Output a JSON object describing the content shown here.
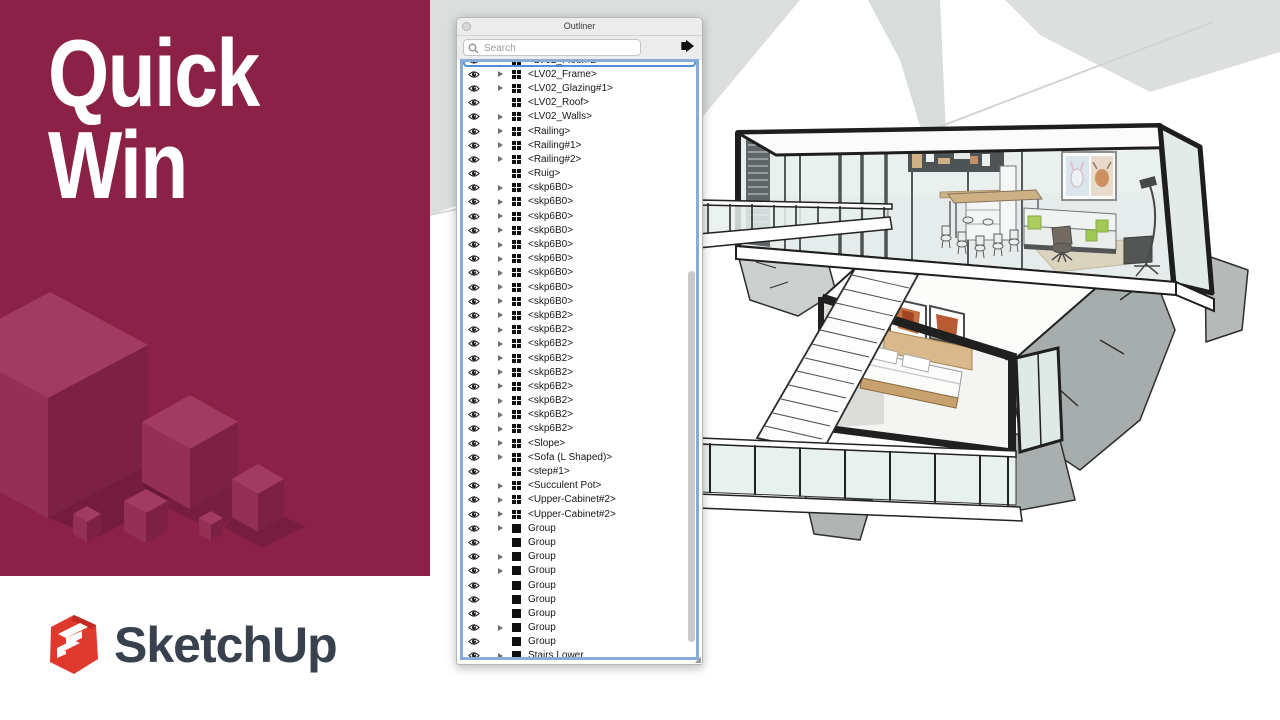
{
  "left_panel": {
    "title_lines": [
      "Quick",
      "Win"
    ],
    "background_color": "#8C2147",
    "brand_name": "SketchUp",
    "logo_red": "#DF392D",
    "brand_text_color": "#39414E"
  },
  "outliner": {
    "window_title": "Outliner",
    "search_placeholder": "Search",
    "search_value": "",
    "focus_ring_color": "#87ACD8",
    "selection_color": "#4E8FD5",
    "icons": {
      "visibility": "eye-icon",
      "component": "component-grid-icon",
      "group": "group-square-icon",
      "search": "magnifier-icon",
      "details": "details-arrow-icon",
      "close": "window-close-icon"
    },
    "rows": [
      {
        "label": "<LV02_Floor#2>",
        "icon": "component",
        "expandable": false,
        "selected": true
      },
      {
        "label": "<LV02_Frame>",
        "icon": "component",
        "expandable": true,
        "selected": false
      },
      {
        "label": "<LV02_Glazing#1>",
        "icon": "component",
        "expandable": true,
        "selected": false
      },
      {
        "label": "<LV02_Roof>",
        "icon": "component",
        "expandable": false,
        "selected": false
      },
      {
        "label": "<LV02_Walls>",
        "icon": "component",
        "expandable": true,
        "selected": false
      },
      {
        "label": "<Railing>",
        "icon": "component",
        "expandable": true,
        "selected": false
      },
      {
        "label": "<Railing#1>",
        "icon": "component",
        "expandable": true,
        "selected": false
      },
      {
        "label": "<Railing#2>",
        "icon": "component",
        "expandable": true,
        "selected": false
      },
      {
        "label": "<Ruig>",
        "icon": "component",
        "expandable": false,
        "selected": false
      },
      {
        "label": "<skp6B0>",
        "icon": "component",
        "expandable": true,
        "selected": false
      },
      {
        "label": "<skp6B0>",
        "icon": "component",
        "expandable": true,
        "selected": false
      },
      {
        "label": "<skp6B0>",
        "icon": "component",
        "expandable": true,
        "selected": false
      },
      {
        "label": "<skp6B0>",
        "icon": "component",
        "expandable": true,
        "selected": false
      },
      {
        "label": "<skp6B0>",
        "icon": "component",
        "expandable": true,
        "selected": false
      },
      {
        "label": "<skp6B0>",
        "icon": "component",
        "expandable": true,
        "selected": false
      },
      {
        "label": "<skp6B0>",
        "icon": "component",
        "expandable": true,
        "selected": false
      },
      {
        "label": "<skp6B0>",
        "icon": "component",
        "expandable": true,
        "selected": false
      },
      {
        "label": "<skp6B0>",
        "icon": "component",
        "expandable": true,
        "selected": false
      },
      {
        "label": "<skp6B2>",
        "icon": "component",
        "expandable": true,
        "selected": false
      },
      {
        "label": "<skp6B2>",
        "icon": "component",
        "expandable": true,
        "selected": false
      },
      {
        "label": "<skp6B2>",
        "icon": "component",
        "expandable": true,
        "selected": false
      },
      {
        "label": "<skp6B2>",
        "icon": "component",
        "expandable": true,
        "selected": false
      },
      {
        "label": "<skp6B2>",
        "icon": "component",
        "expandable": true,
        "selected": false
      },
      {
        "label": "<skp6B2>",
        "icon": "component",
        "expandable": true,
        "selected": false
      },
      {
        "label": "<skp6B2>",
        "icon": "component",
        "expandable": true,
        "selected": false
      },
      {
        "label": "<skp6B2>",
        "icon": "component",
        "expandable": true,
        "selected": false
      },
      {
        "label": "<skp6B2>",
        "icon": "component",
        "expandable": true,
        "selected": false
      },
      {
        "label": "<Slope>",
        "icon": "component",
        "expandable": true,
        "selected": false
      },
      {
        "label": "<Sofa (L Shaped)>",
        "icon": "component",
        "expandable": true,
        "selected": false
      },
      {
        "label": "<step#1>",
        "icon": "component",
        "expandable": false,
        "selected": false
      },
      {
        "label": "<Succulent Pot>",
        "icon": "component",
        "expandable": true,
        "selected": false
      },
      {
        "label": "<Upper-Cabinet#2>",
        "icon": "component",
        "expandable": true,
        "selected": false
      },
      {
        "label": "<Upper-Cabinet#2>",
        "icon": "component",
        "expandable": true,
        "selected": false
      },
      {
        "label": "Group",
        "icon": "group",
        "expandable": true,
        "selected": false
      },
      {
        "label": "Group",
        "icon": "group",
        "expandable": false,
        "selected": false
      },
      {
        "label": "Group",
        "icon": "group",
        "expandable": true,
        "selected": false
      },
      {
        "label": "Group",
        "icon": "group",
        "expandable": true,
        "selected": false
      },
      {
        "label": "Group",
        "icon": "group",
        "expandable": false,
        "selected": false
      },
      {
        "label": "Group",
        "icon": "group",
        "expandable": false,
        "selected": false
      },
      {
        "label": "Group",
        "icon": "group",
        "expandable": false,
        "selected": false
      },
      {
        "label": "Group",
        "icon": "group",
        "expandable": true,
        "selected": false
      },
      {
        "label": "Group",
        "icon": "group",
        "expandable": false,
        "selected": false
      },
      {
        "label": "Stairs Lower",
        "icon": "group",
        "expandable": true,
        "selected": false
      }
    ]
  },
  "scene": {
    "description": "SketchUp 3D cutaway model of a modern cliffside house with glass upper floor, staircase, bedroom and deck"
  }
}
